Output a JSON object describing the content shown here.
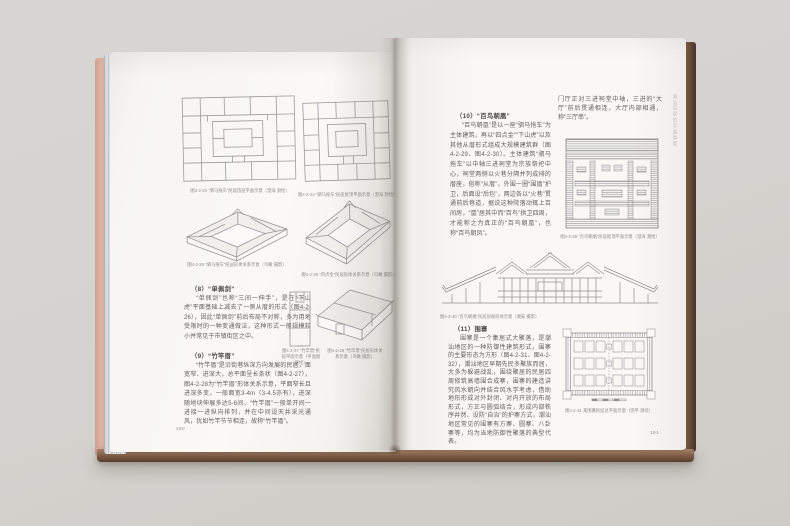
{
  "book": {
    "left_page": {
      "page_number": "190",
      "sections": [
        {
          "heading": "（8）“单佩剑”",
          "body": "“单佩剑”也称“三间一伸手”，是在“下山虎”平面基础上减去了一侧从厝的形式（图4-2-26），因此“单佩剑”前后布局不对称，多为用地受限时的一种变通做法，这种形式一般规模较小并常见于市镇街区之中。"
        },
        {
          "heading": "（9）“竹竿厝”",
          "body": "“竹竿厝”是沿街巷纵深方向发展的民居，面宽窄、进深大，总平面呈长条状（图4-2-27），图4-2-28为“竹竿厝”形体关系示意，平面窄长且进深多变，一般面宽3-4m（3-4.5亦有），进深随地块伸展多达5-6间，“竹竿厝”一般单开间一进接一进纵向排列，并在中间设天井采光通风，犹如竹竿节节相连，故称“竹竿厝”。"
        }
      ],
      "figures": {
        "plan1_caption": "图4-2-23 “驷马拖车”民居首层平面示意（澄海 测绘）",
        "plan2_caption": "图4-2-24 “驷马拖车”民居屋顶平面示意（澄海 测绘）",
        "axon1_caption": "图4-2-25 “驷马拖车”民居形体关系示意（鸟瞰 摄影）",
        "axon2_caption": "图4-2-26 “四点金”民居形体关系示意（鸟瞰 摄影）",
        "strip_plan_caption": "图4-2-27 “竹竿厝”民居平面示意（平面图 测绘）",
        "house_axon_caption": "图4-2-28 “竹竿厝”民居形体关系示意（鸟瞰 摄影）"
      }
    },
    "right_page": {
      "page_number": "191",
      "running_header": "潮汕民居的平面类型",
      "top_continuation": "门厅正对三进祠堂中轴，三进的“大厅”前后贯通相连，大厅内部相通，称“三厅串”。",
      "sections": [
        {
          "heading": "（10）“百鸟朝凰”",
          "body": "“百鸟朝凰”是以一座“驷马拖车”为主体建筑，再以“四点金”“下山虎”以及其他从厝形式组成大规模建筑群（图4-2-29、图4-2-30）。主体建筑“驷马拖车”以中轴三进祠堂为宗族祭祀中心，祠堂两侧以火巷分隔并列成排的厝座，俗称“从厝”，外围一圈“围厝”护卫，后面设“后包”，两边各以“火巷”贯通前后巷道，据说这种院落动辄上百间房，“凰”居其中而“百鸟”拱卫四周，才能称之为真正的“百鸟朝凰”，也称“百鸟朝凤”。"
        },
        {
          "heading": "（11）围寨",
          "body": "围寨是一个集居式大聚落，是潮汕地区的一种防御性建筑形式，围寨的主要形态为方形（图4-2-31、图4-2-32），潮汕地区早期先民多聚族而居，大多为躲避战乱，围绕聚居的民居四周修筑高墙围合成寨，围寨的建造讲究风水朝向并结合风水学考虑，借助地形形成对外封闭、对内开放的布局形式，方正与圆弧结合，形成内部秩序井然、设防“自治”的护寨方式，潮汕地区常见的围寨有方寨、圆寨、八卦寨等，均为当地防御性聚落的典型代表。"
        }
      ],
      "figures": {
        "roof_plan_caption": "图4-2-29 “百鸟朝凰”民居屋顶平面示意（澄海 测绘）",
        "section_caption": "图4-2-30 “百鸟朝凰”民居剖视形体示意（潮安 摄影）",
        "compound_caption": "图4-2-31 某围寨民居总平面示意（饶平 测绘）"
      }
    }
  },
  "colors": {
    "background": "#d5d3cf",
    "page": "#f9f8f5",
    "cover_brown": "#5d4233",
    "cover_pink": "#d7ab99",
    "drawing_line": "#9a9a9a",
    "body_text": "#615f5c"
  }
}
